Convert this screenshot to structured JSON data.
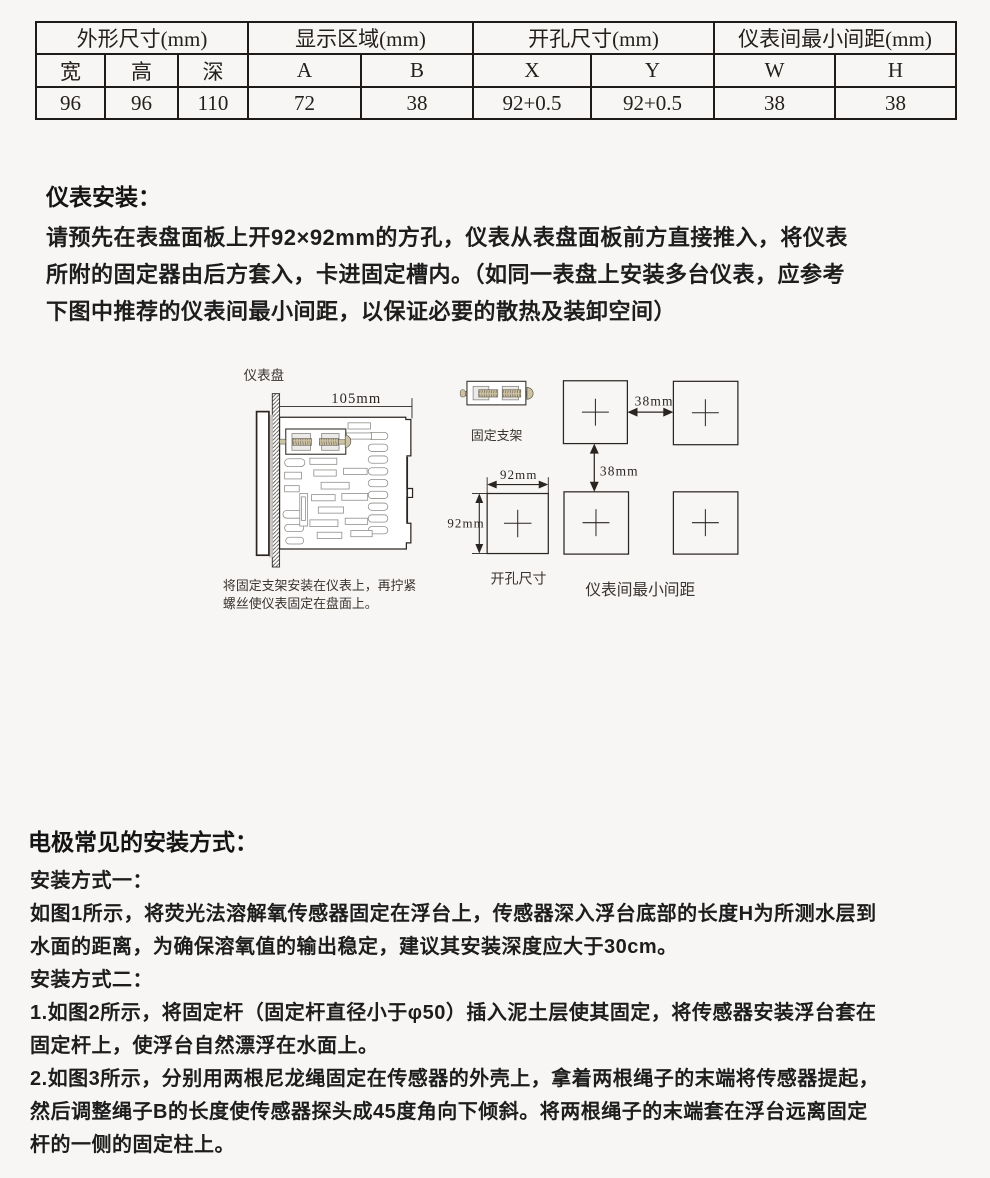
{
  "spec_table": {
    "groups": [
      {
        "label": "外形尺寸(mm)",
        "cols": [
          "宽",
          "高",
          "深"
        ],
        "values": [
          "96",
          "96",
          "110"
        ]
      },
      {
        "label": "显示区域(mm)",
        "cols": [
          "A",
          "B"
        ],
        "values": [
          "72",
          "38"
        ]
      },
      {
        "label": "开孔尺寸(mm)",
        "cols": [
          "X",
          "Y"
        ],
        "values": [
          "92+0.5",
          "92+0.5"
        ]
      },
      {
        "label": "仪表间最小间距(mm)",
        "cols": [
          "W",
          "H"
        ],
        "values": [
          "38",
          "38"
        ]
      }
    ]
  },
  "install_section": {
    "heading": "仪表安装：",
    "lines": [
      "请预先在表盘面板上开92×92mm的方孔，仪表从表盘面板前方直接推入，将仪表",
      "所附的固定器由后方套入，卡进固定槽内。（如同一表盘上安装多台仪表，应参考",
      "下图中推荐的仪表间最小间距，以保证必要的散热及装卸空间）"
    ]
  },
  "diagram": {
    "panel_label": "仪表盘",
    "dim_105": "105mm",
    "bracket_label": "固定支架",
    "dim_38_h": "38mm",
    "dim_38_v": "38mm",
    "dim_92_w": "92mm",
    "dim_92_h": "92mm",
    "cutout_label": "开孔尺寸",
    "spacing_label": "仪表间最小间距",
    "caption_line1": "将固定支架安装在仪表上，再拧紧",
    "caption_line2": "螺丝使仪表固定在盘面上。"
  },
  "electrode_section": {
    "heading": "电极常见的安装方式：",
    "method1_label": "安装方式一：",
    "method1_lines": [
      "如图1所示，将荧光法溶解氧传感器固定在浮台上，传感器深入浮台底部的长度H为所测水层到",
      "水面的距离，为确保溶氧值的输出稳定，建议其安装深度应大于30cm。"
    ],
    "method2_label": "安装方式二：",
    "method2_lines": [
      "1.如图2所示，将固定杆（固定杆直径小于φ50）插入泥土层使其固定，将传感器安装浮台套在",
      "固定杆上，使浮台自然漂浮在水面上。",
      "2.如图3所示，分别用两根尼龙绳固定在传感器的外壳上，拿着两根绳子的末端将传感器提起，",
      "然后调整绳子B的长度使传感器探头成45度角向下倾斜。将两根绳子的末端套在浮台远离固定",
      "杆的一侧的固定柱上。"
    ]
  }
}
